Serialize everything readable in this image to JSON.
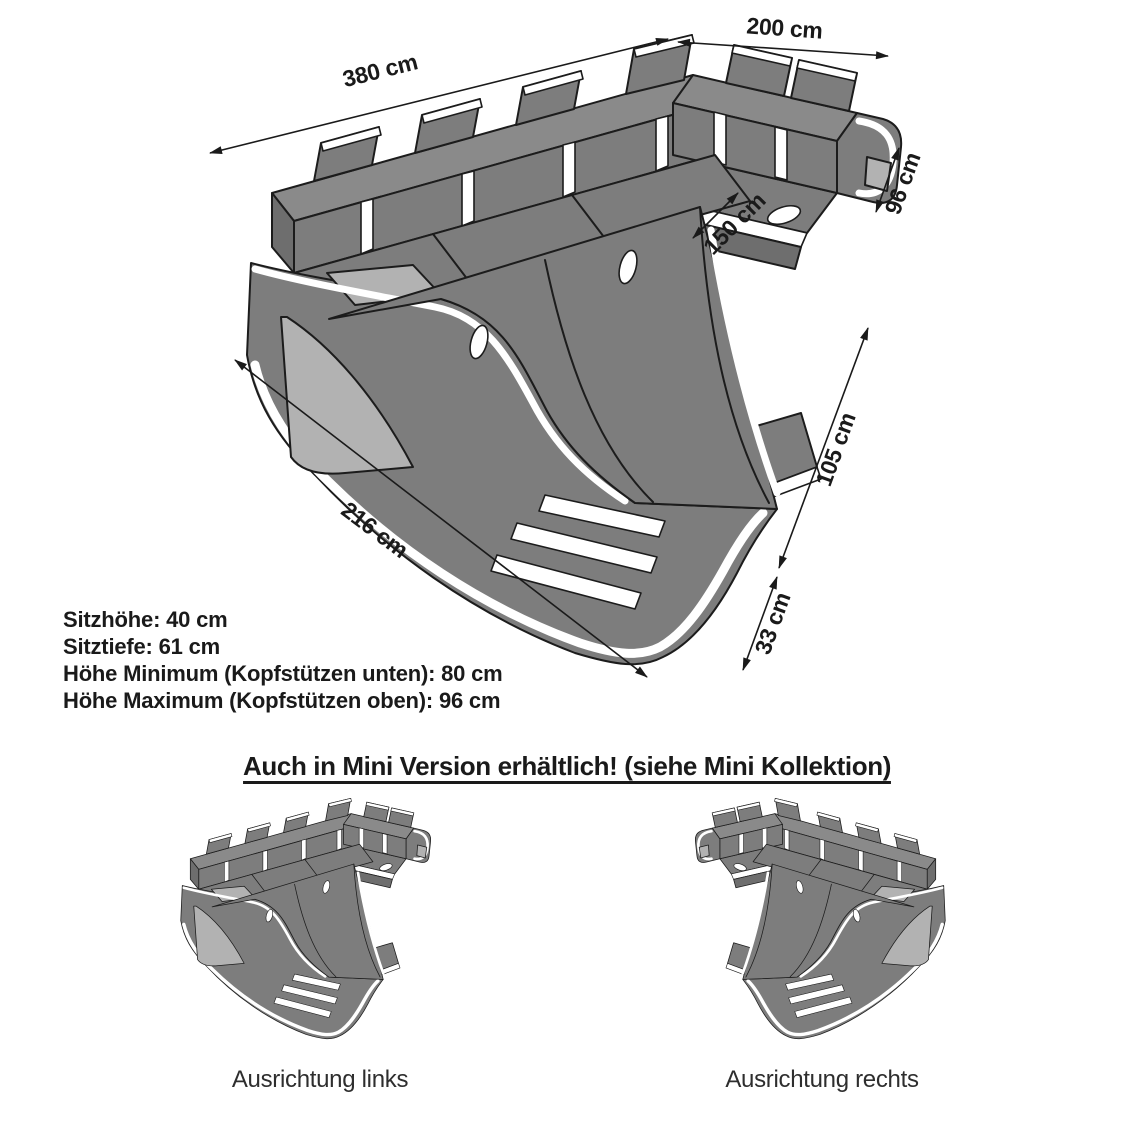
{
  "diagram": {
    "dimensions": {
      "total_width": "380 cm",
      "right_depth": "200 cm",
      "back_height": "96 cm",
      "inner_width": "150 cm",
      "recamiere_depth": "105 cm",
      "base_height": "33 cm",
      "left_width": "216 cm"
    },
    "specs": [
      "Sitzhöhe: 40 cm",
      "Sitztiefe: 61 cm",
      "Höhe Minimum (Kopfstützen unten): 80 cm",
      "Höhe Maximum (Kopfstützen oben): 96 cm"
    ],
    "mini_heading": "Auch in Mini Version erhältlich! (siehe Mini Kollektion)",
    "variants": [
      {
        "label": "Ausrichtung links"
      },
      {
        "label": "Ausrichtung rechts"
      }
    ],
    "colors": {
      "sofa-body": "#7d7d7d",
      "sofa-top": "#8a8a8a",
      "sofa-dark": "#6e6e6e",
      "sofa-panel": "#b2b2b2",
      "stripe": "#ffffff",
      "line": "#1c1c1c",
      "text": "#1a1a1a"
    }
  }
}
